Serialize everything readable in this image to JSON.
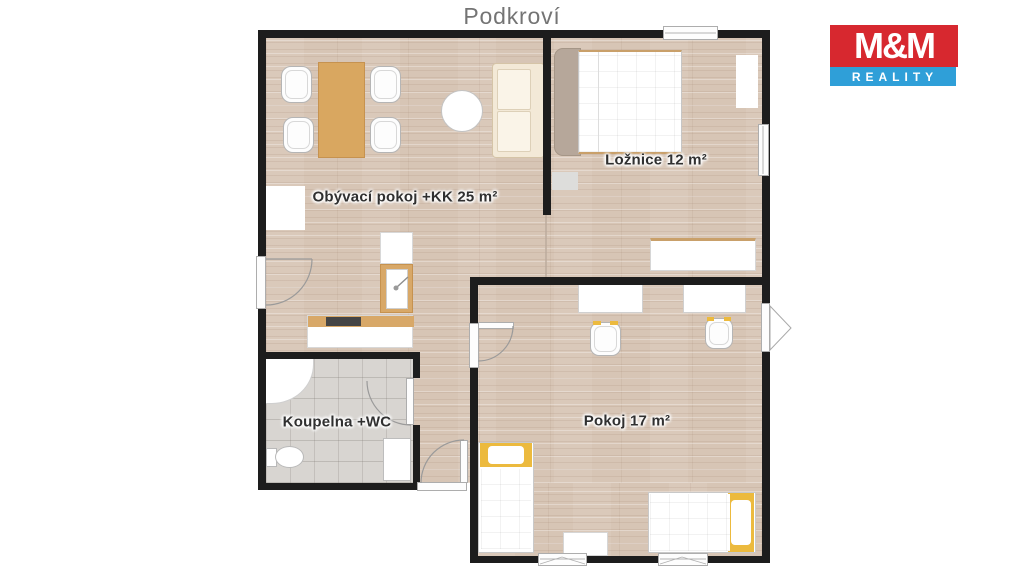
{
  "title": "Podkroví",
  "logo": {
    "top": "M&M",
    "bottom": "REALITY",
    "red": "#d7282f",
    "blue": "#2f9fd8"
  },
  "rooms": [
    {
      "id": "living-room",
      "label": "Obývací pokoj +KK 25 m²"
    },
    {
      "id": "bedroom",
      "label": "Ložnice 12 m²"
    },
    {
      "id": "bathroom",
      "label": "Koupelna +WC"
    },
    {
      "id": "room",
      "label": "Pokoj 17 m²"
    }
  ],
  "palette": {
    "wall": "#1d1d1d",
    "wood_floor": "#d7c5b5",
    "tile_floor": "#d8d5d1",
    "table_wood": "#d9a760",
    "sofa_cream": "#f3e9d7",
    "accent_yellow": "#ecba3e",
    "label_text": "#303030",
    "title_text": "#747474"
  }
}
